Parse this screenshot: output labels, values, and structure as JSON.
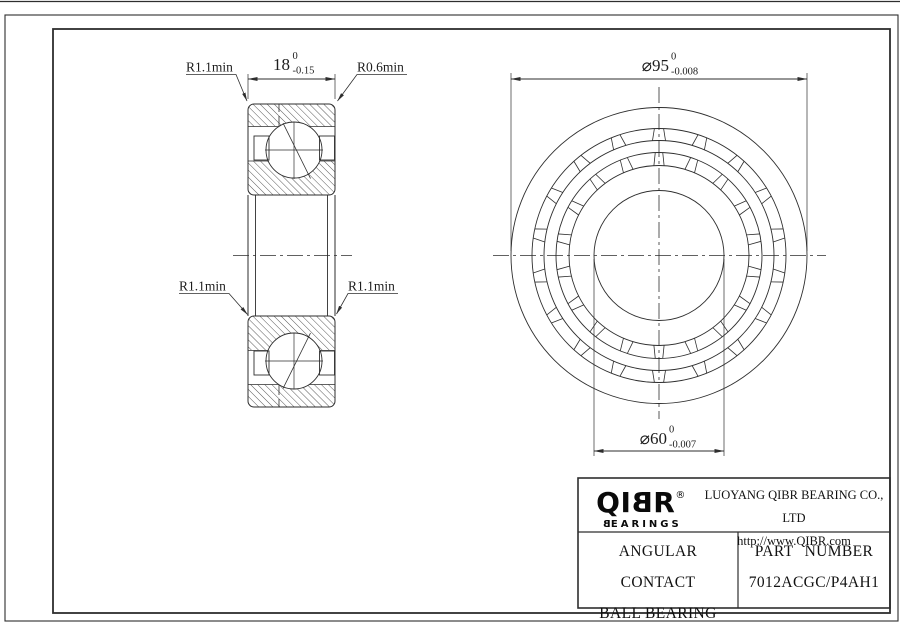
{
  "section_view": {
    "width_dim": {
      "value": "18",
      "tol_upper": "0",
      "tol_lower": "-0.15"
    },
    "radius_top_left": "R1.1min",
    "radius_top_right": "R0.6min",
    "radius_mid_left": "R1.1min",
    "radius_mid_right": "R1.1min"
  },
  "front_view": {
    "outer_diameter": {
      "value": "⌀95",
      "tol_upper": "0",
      "tol_lower": "-0.008"
    },
    "bore_diameter": {
      "value": "⌀60",
      "tol_upper": "0",
      "tol_lower": "-0.007"
    }
  },
  "title_block": {
    "logo_qi": "QI",
    "logo_b": "B",
    "logo_r": "R",
    "logo_registered": "®",
    "logo_sub_b": "B",
    "logo_sub_rest": "EARINGS",
    "company_name": "LUOYANG QIBR BEARING CO., LTD",
    "website": "http://www.QIBR.com",
    "product_line1": "ANGULAR CONTACT",
    "product_line2": "BALL BEARING",
    "part_number_label": "PART NUMBER",
    "part_number": "7012ACGC/P4AH1"
  },
  "colors": {
    "line": "#2e2e2e",
    "background": "#ffffff",
    "frame": "#6a6a6a"
  }
}
